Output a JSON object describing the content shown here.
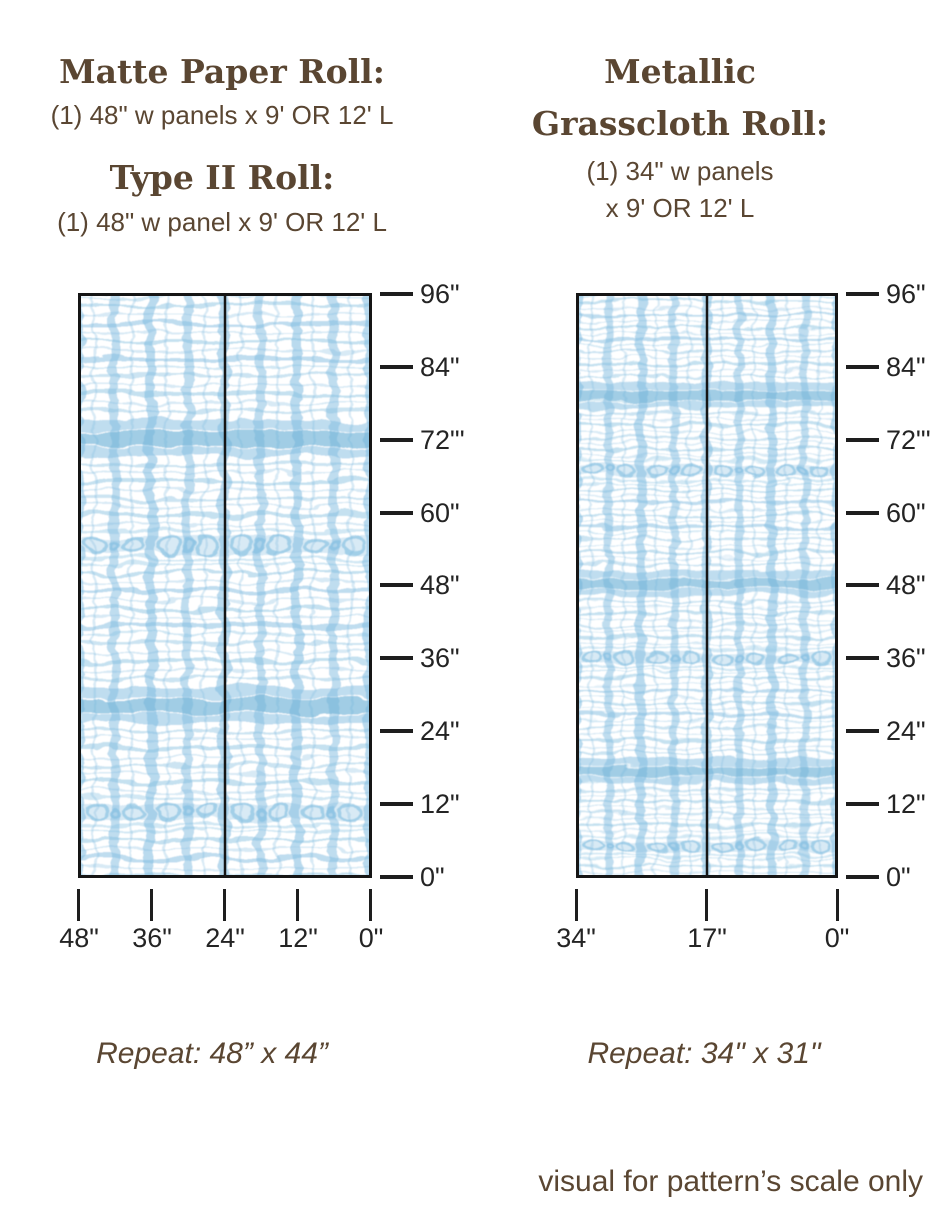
{
  "page": {
    "background_color": "#ffffff",
    "text_brown": "#5a4632",
    "ruler_color": "#1e1e1e",
    "pattern_blue": "#7fbcdf",
    "footnote": "visual for pattern’s scale only"
  },
  "headers": {
    "left": {
      "title_1": "Matte Paper Roll:",
      "subtitle_1": "(1) 48\" w panels x 9' OR 12' L",
      "title_2": "Type II Roll:",
      "subtitle_2": "(1) 48\" w panel x 9' OR 12' L"
    },
    "right": {
      "title_line_1": "Metallic",
      "title_line_2": "Grasscloth Roll:",
      "subtitle_line_1": "(1) 34\" w panels",
      "subtitle_line_2": "x 9' OR 12' L"
    }
  },
  "diagrams": [
    {
      "id": "matte-paper-type-ii-roll",
      "panels": 2,
      "height_ruler": [
        "96\"",
        "84\"",
        "72\"'",
        "60\"",
        "48\"",
        "36\"",
        "24\"",
        "12\"",
        "0\""
      ],
      "width_ruler": [
        "48\"",
        "36\"",
        "24\"",
        "12\"",
        "0\""
      ],
      "repeat": "Repeat: 48” x 44”"
    },
    {
      "id": "metallic-grasscloth-roll",
      "panels": 2,
      "height_ruler": [
        "96\"",
        "84\"",
        "72\"'",
        "60\"",
        "48\"",
        "36\"",
        "24\"",
        "12\"",
        "0\""
      ],
      "width_ruler": [
        "34\"",
        "17\"",
        "0\""
      ],
      "repeat": "Repeat: 34\" x 31\""
    }
  ]
}
